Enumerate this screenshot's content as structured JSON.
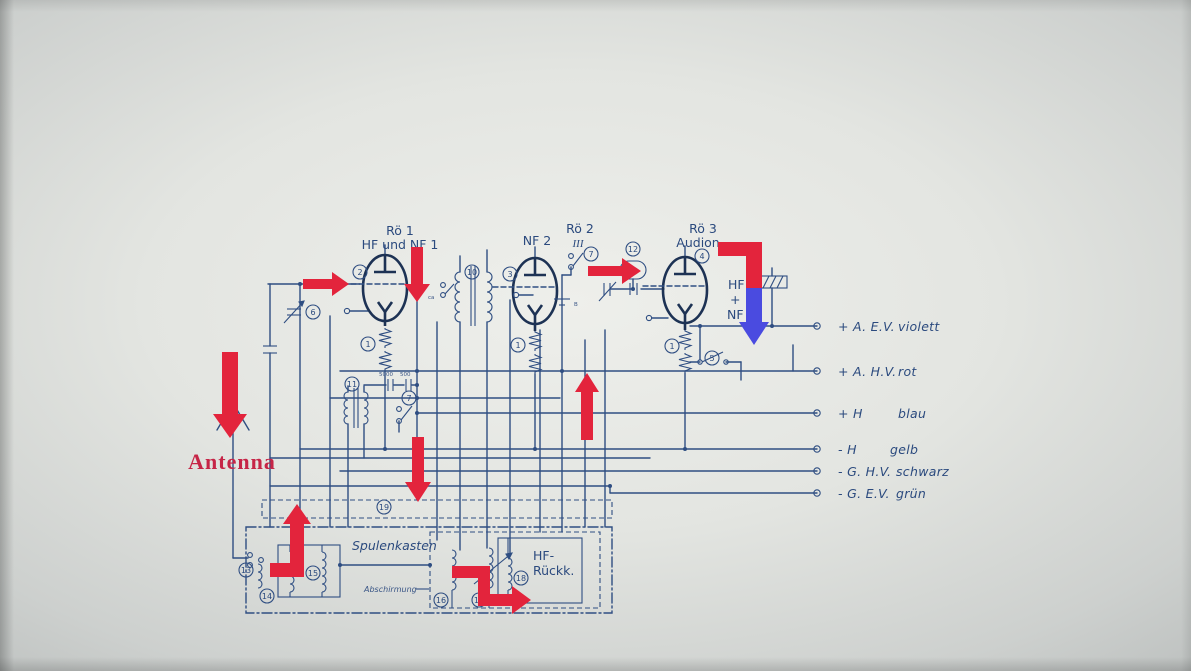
{
  "labels": {
    "antenna": "Antenna",
    "tube1_name": "Rö 1",
    "tube1_desc": "HF und NF 1",
    "tube2_input": "NF 2",
    "tube2_name": "Rö 2",
    "tube2_numeral": "III",
    "tube3_name": "Rö 3",
    "tube3_desc": "Audion.",
    "hf": "HF",
    "plus": "+",
    "nf": "NF",
    "coil_box": "Spulenkasten",
    "shield": "Abschirmung",
    "feedback_line1": "HF-",
    "feedback_line2": "Rückk.",
    "tiny_ca": "ca",
    "tiny_b": "B",
    "tiny_cap1": "5000",
    "tiny_cap2": "500"
  },
  "terminals": [
    {
      "name": "+ A. E.V.",
      "color": "violett"
    },
    {
      "name": "+ A. H.V.",
      "color": "rot"
    },
    {
      "name": "+ H",
      "color": "blau"
    },
    {
      "name": "- H",
      "color": "gelb"
    },
    {
      "name": "- G. H.V.",
      "color": "schwarz"
    },
    {
      "name": "- G. E.V.",
      "color": "grün"
    }
  ],
  "circled": [
    {
      "label": "2"
    },
    {
      "label": "10"
    },
    {
      "label": "3"
    },
    {
      "label": "7"
    },
    {
      "label": "12"
    },
    {
      "label": "4"
    },
    {
      "label": "6"
    },
    {
      "label": "1"
    },
    {
      "label": "11"
    },
    {
      "label": "7"
    },
    {
      "label": "1"
    },
    {
      "label": "1"
    },
    {
      "label": "5"
    },
    {
      "label": "19"
    },
    {
      "label": "13"
    },
    {
      "label": "14"
    },
    {
      "label": "15"
    },
    {
      "label": "16"
    },
    {
      "label": "17"
    },
    {
      "label": "18"
    }
  ],
  "colors": {
    "ink": "#2f4e82",
    "tube_ink": "#1d3254",
    "arrow_red": "#e3243c",
    "arrow_blue": "#4a4be0",
    "antenna_text": "#c62547",
    "paper": "#eeefeb",
    "edge": "#a5a9a8"
  }
}
